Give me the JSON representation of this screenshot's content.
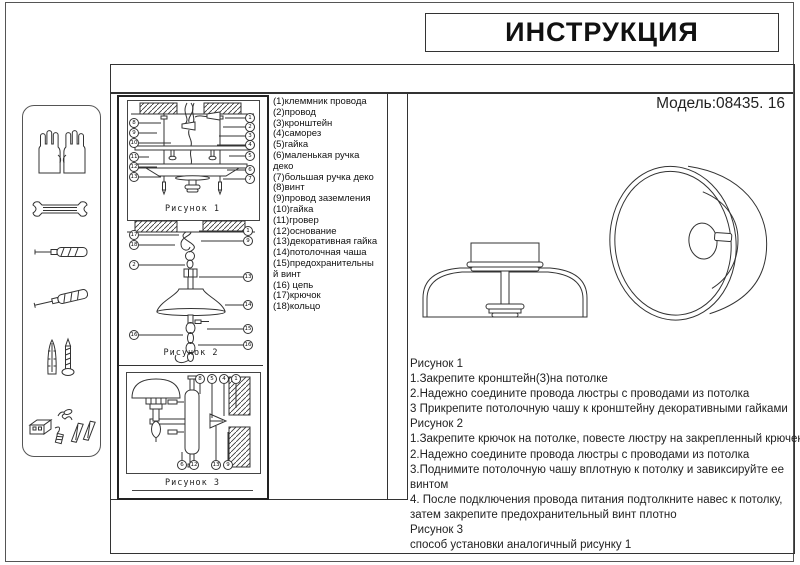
{
  "page": {
    "title": "ИНСТРУКЦИЯ",
    "model": "Модель:08435. 16"
  },
  "colors": {
    "line": "#333333",
    "text": "#111111",
    "background": "#ffffff"
  },
  "parts": [
    "(1)клеммник провода",
    "(2)провод",
    "(3)кронштейн",
    "(4)саморез",
    "(5)гайка",
    "(6)маленькая ручка деко",
    "(7)большая ручка деко",
    "(8)винт",
    "(9)провод заземления",
    "(10)гайка",
    "(11)гровер",
    "(12)основание",
    "(13)декоративная гайка",
    "(14)потолочная чаша",
    "(15)предохранительный винт",
    "(16) цепь",
    "(17)крючок",
    "(18)кольцо"
  ],
  "figures": {
    "fig1": {
      "caption": "Рисунок 1",
      "left": [
        "8",
        "9",
        "10",
        "11",
        "12",
        "13"
      ],
      "right": [
        "1",
        "2",
        "3",
        "4",
        "5",
        "6",
        "7"
      ]
    },
    "fig2": {
      "caption": "Рисунок 2",
      "left": [
        "17",
        "18",
        "2",
        "16"
      ],
      "right": [
        "1",
        "9",
        "13",
        "14",
        "15",
        "16"
      ]
    },
    "fig3": {
      "caption": "Рисунок 3",
      "top": [
        "8",
        "5",
        "4",
        "1"
      ],
      "bottom": [
        "6",
        "12",
        "13",
        "9"
      ]
    }
  },
  "instructions": {
    "lines": [
      "Рисунок 1",
      "1.Закрепите кронштейн(3)на потолке",
      "2.Надежно соедините провода люстры с проводами из потолка",
      "3 Прикрепите потолочную чашу к кронштейну декоративными гайками",
      "Рисунок 2",
      "1.Закрепите крючок на потолке, повесте люстру на закрепленный крючек",
      "2.Надежно соедините провода люстры с проводами из потолка",
      "3.Поднимите потолочную чашу вплотную к потолку и завиксируйте ее",
      "винтом",
      "4.  После подключения провода питания подтолкните навес к потолку,",
      "затем закрепите предохранительный винт плотно",
      " Рисунок 3",
      " способ установки аналогичный рисунку 1"
    ]
  },
  "sidebar": {
    "tools": [
      "gloves-icon",
      "wrench-icon",
      "screwdriver-icon",
      "screwdriver-angled-icon",
      "anchor-screw-icon",
      "fasteners-icon"
    ]
  }
}
